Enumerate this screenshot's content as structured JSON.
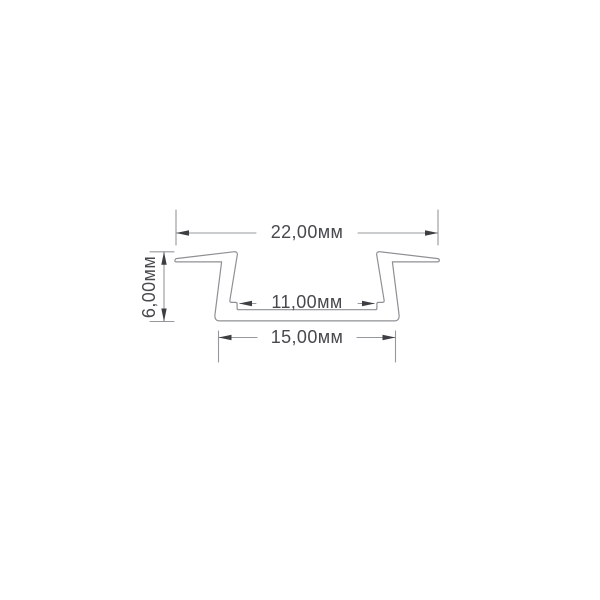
{
  "drawing": {
    "type": "technical-cross-section",
    "subject": "recessed-led-profile-channel",
    "units": "мм",
    "dimensions": {
      "outer_width": {
        "label": "22,00мм",
        "value": 22.0
      },
      "inner_width": {
        "label": "11,00мм",
        "value": 11.0
      },
      "base_width": {
        "label": "15,00мм",
        "value": 15.0
      },
      "height": {
        "label": "6,00мм",
        "value": 6.0
      }
    },
    "style": {
      "line_color": "#95989c",
      "outline_color": "#8d9094",
      "arrow_color": "#3d3f43",
      "text_color": "#47494d",
      "background": "#ffffff"
    }
  }
}
